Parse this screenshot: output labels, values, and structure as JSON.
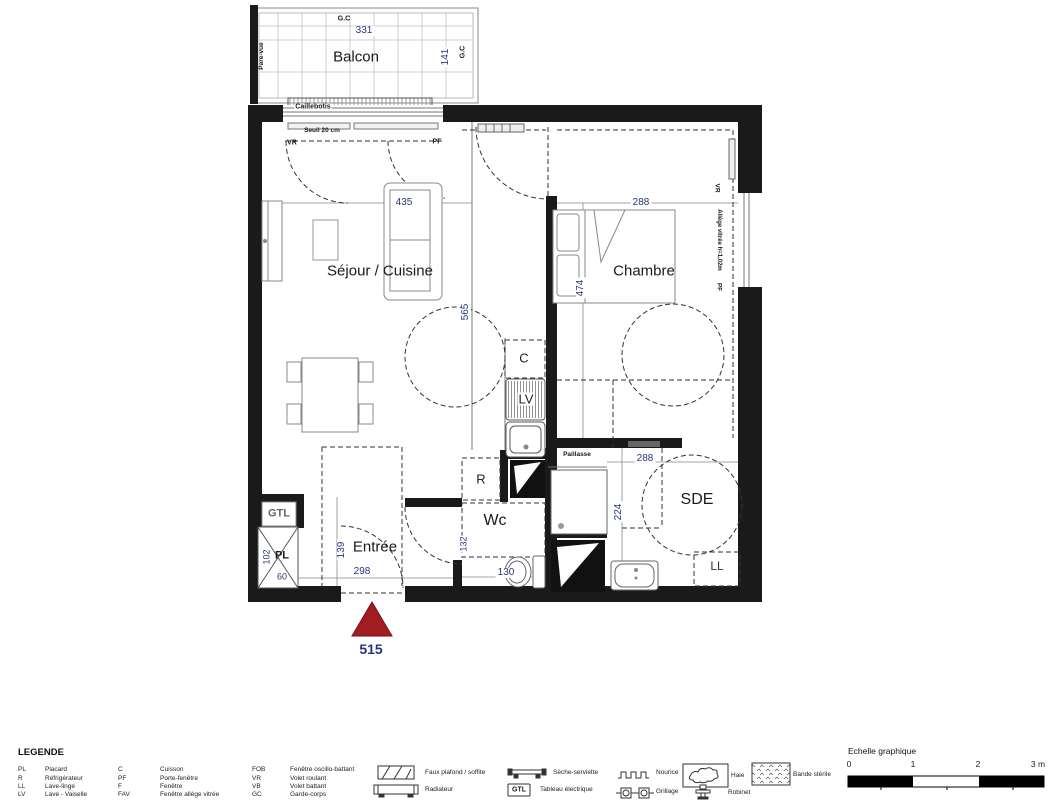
{
  "colors": {
    "dimension_text": "#25357d",
    "lot_marker": "#a11d22",
    "wall": "#1a1a1a"
  },
  "plan": {
    "balcony": {
      "label": "Balcon",
      "gc_top": "G.C",
      "gc_side": "G.C",
      "width": "331",
      "depth": "141",
      "pare_vue": "Pare-vue",
      "decking": "Caillebotis",
      "threshold": "Seuil 20 cm",
      "shutter": "VR",
      "door": "PF"
    },
    "rooms": {
      "sejour": "Séjour / Cuisine",
      "chambre": "Chambre",
      "entree": "Entrée",
      "wc": "Wc",
      "sde": "SDE"
    },
    "dimensions": {
      "sejour_width": "435",
      "sejour_depth": "565",
      "chambre_width": "288",
      "chambre_depth": "474",
      "entree_width": "298",
      "entree_depth": "139",
      "placard_depth": "102",
      "placard_width": "60",
      "wc_width": "130",
      "wc_depth": "132",
      "sde_width": "288",
      "sde_depth": "224"
    },
    "fixtures": {
      "cuisson": "C",
      "lave_vaisselle": "LV",
      "refrigerateur": "R",
      "tableau": "GTL",
      "placard": "PL",
      "lave_linge": "LL",
      "paillasse": "Paillasse"
    },
    "right_window": {
      "shutter": "VR",
      "allege": "Allège vitrée h=1,02m",
      "door": "PF"
    },
    "lot_number": "515"
  },
  "legend": {
    "title": "LEGENDE",
    "abbreviations": [
      {
        "abbr": "PL",
        "label": "Placard"
      },
      {
        "abbr": "R",
        "label": "Réfrigérateur"
      },
      {
        "abbr": "LL",
        "label": "Lave-linge"
      },
      {
        "abbr": "LV",
        "label": "Lave - Vaiselle"
      },
      {
        "abbr": "C",
        "label": "Cuisson"
      },
      {
        "abbr": "PF",
        "label": "Porte-fenêtre"
      },
      {
        "abbr": "F",
        "label": "Fenêtre"
      },
      {
        "abbr": "FAV",
        "label": "Fenêtre allège vitrée"
      },
      {
        "abbr": "FOB",
        "label": "Fenêtre oscillo-battant"
      },
      {
        "abbr": "VR",
        "label": "Volet roulant"
      },
      {
        "abbr": "VB",
        "label": "Volet battant"
      },
      {
        "abbr": "GC",
        "label": "Garde-corps"
      }
    ],
    "symbols": {
      "faux_plafond": "Faux plafond / soffite",
      "radiateur": "Radiateur",
      "seche_serviette": "Sèche-serviette",
      "tableau_badge": "GTL",
      "tableau": "Tableau électrique",
      "nourice": "Nourice",
      "grillage": "Grillage",
      "haie": "Haie",
      "robinet": "Robinet",
      "bande_sterile": "Bande stérile"
    }
  },
  "scale": {
    "title": "Echelle graphique",
    "ticks": [
      "0",
      "1",
      "2",
      "3 m"
    ]
  }
}
